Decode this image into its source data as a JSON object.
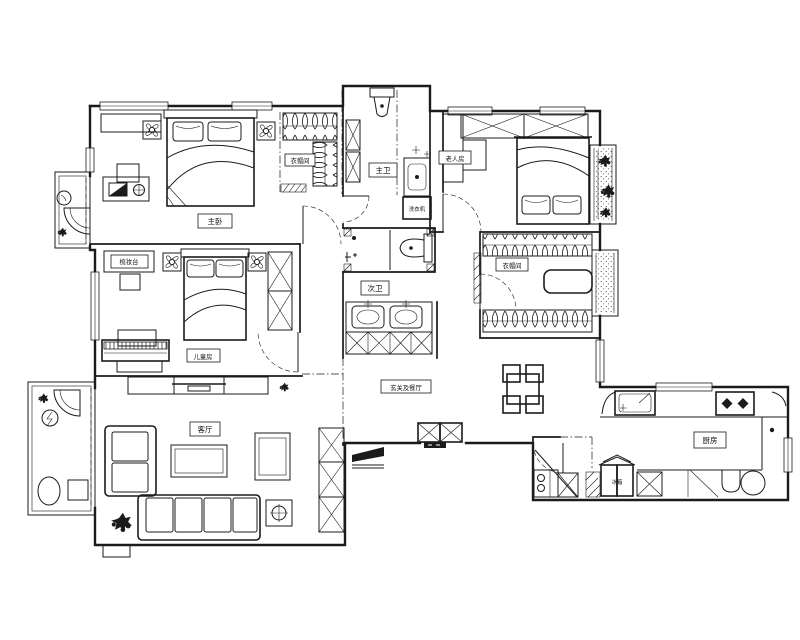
{
  "labels": {
    "master_bedroom": "主卧",
    "master_closet": "衣帽间",
    "master_bath": "主卫",
    "washer": "洗衣机",
    "elder_room": "老人房",
    "cloakroom": "衣帽间",
    "guest_bath": "次卫",
    "kids_room": "儿童房",
    "dresser": "梳妆台",
    "living_room": "客厅",
    "foyer_dining": "玄关及餐厅",
    "kitchen": "厨房",
    "fridge": "冰箱"
  },
  "colors": {
    "line": "#1b1b1b",
    "background": "#ffffff"
  }
}
